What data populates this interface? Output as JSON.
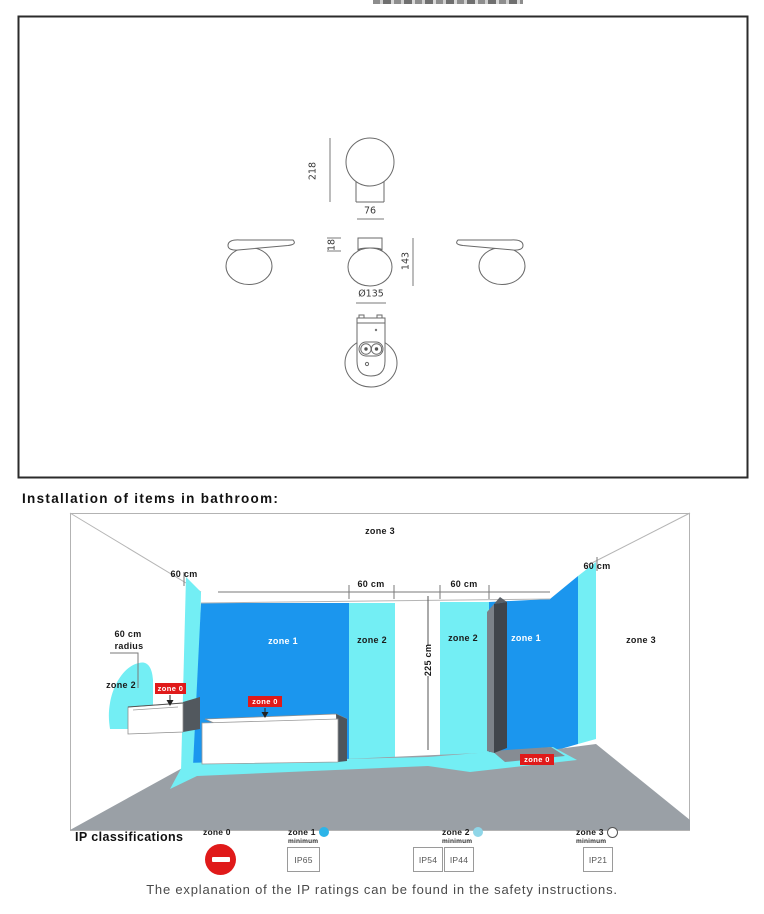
{
  "figure": {
    "dimensions": {
      "total_height": "218",
      "base_width": "76",
      "canopy_height": "18",
      "fixture_height": "143",
      "diameter": "Ø135"
    }
  },
  "heading": "Installation of items in bathroom:",
  "diagram": {
    "zones": {
      "zone0": "zone 0",
      "zone1": "zone 1",
      "zone2": "zone 2",
      "zone3": "zone 3"
    },
    "dims": {
      "sixty": "60 cm",
      "height": "225 cm",
      "radius_line1": "60 cm",
      "radius_line2": "radius"
    }
  },
  "legend": {
    "title": "IP classifications",
    "minimum_label": "minimum",
    "items": [
      {
        "zone": "zone 0",
        "ratings": []
      },
      {
        "zone": "zone 1",
        "ratings": [
          "IP65"
        ]
      },
      {
        "zone": "zone 2",
        "ratings": [
          "IP54",
          "IP44"
        ]
      },
      {
        "zone": "zone 3",
        "ratings": [
          "IP21"
        ]
      }
    ]
  },
  "footer": "The explanation of the IP ratings can be found in the safety instructions.",
  "colors": {
    "zone1_blue": "#1b96ee",
    "zone2_cyan": "#73eef4",
    "zone0_red": "#e01a1a",
    "legend_dot_zone1": "#2cb4e8",
    "legend_dot_zone2": "#8fd6e8",
    "floor_gray": "#9aa0a6"
  }
}
